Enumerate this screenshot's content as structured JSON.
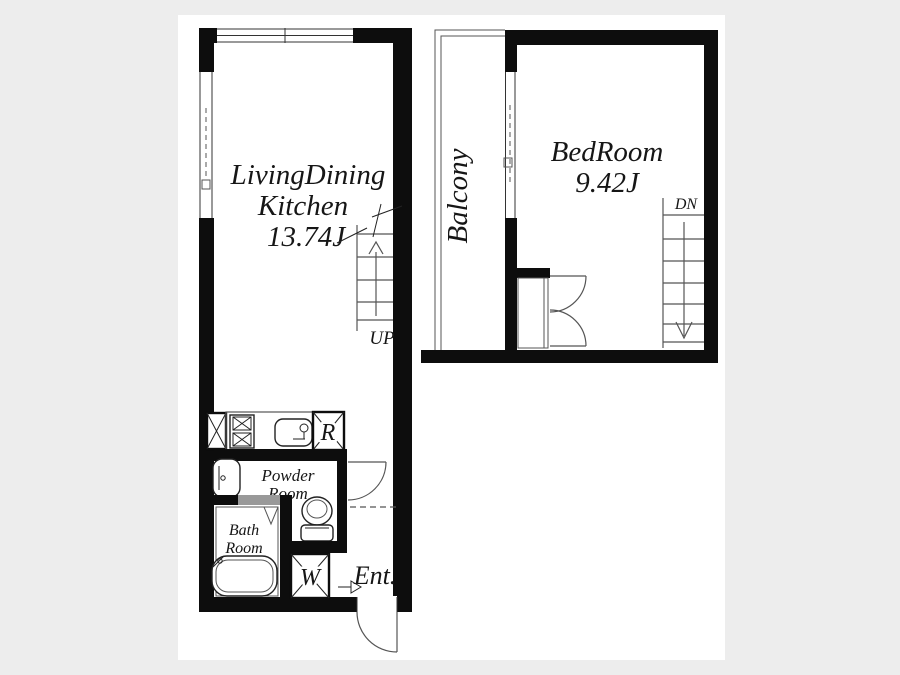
{
  "plan": {
    "units": {
      "ldk": {
        "label_line1": "LivingDining",
        "label_line2": "Kitchen",
        "size": "13.74J"
      },
      "bedroom": {
        "label": "BedRoom",
        "size": "9.42J"
      },
      "balcony": {
        "label": "Balcony"
      },
      "powder_room": {
        "label_line1": "Powder",
        "label_line2": "Room"
      },
      "bath_room": {
        "label_line1": "Bath",
        "label_line2": "Room"
      },
      "entrance": {
        "label": "Ent."
      }
    },
    "stairs": {
      "up_label": "UP",
      "dn_label": "DN"
    },
    "appliances": {
      "refrigerator": "R",
      "washer": "W"
    },
    "colors": {
      "wall": "#0d0d0d",
      "line": "#555555",
      "bg": "#ededed",
      "paper": "#ffffff",
      "gray": "#999999",
      "ink": "#161616"
    }
  }
}
